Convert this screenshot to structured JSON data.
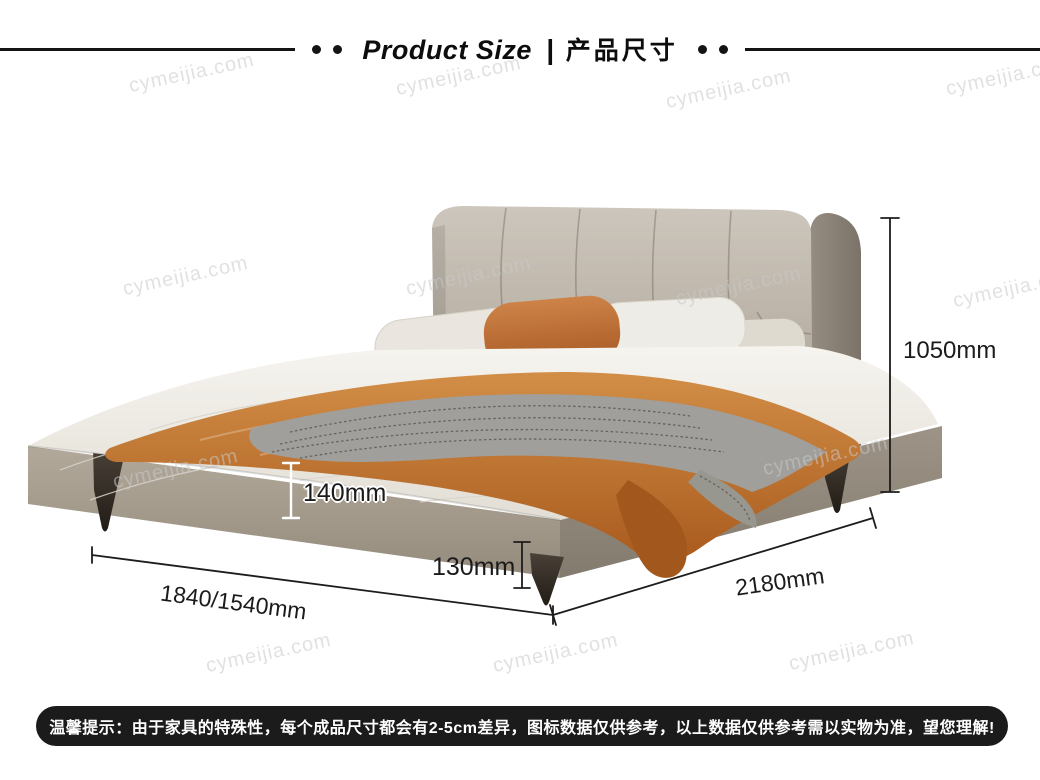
{
  "header": {
    "title_en": "Product Size",
    "separator": "|",
    "title_cn": "产品尺寸"
  },
  "watermark": {
    "text": "cymeijia.com"
  },
  "dimensions": {
    "height": "1050mm",
    "frame_height": "140mm",
    "leg_height": "130mm",
    "width": "1840/1540mm",
    "depth": "2180mm"
  },
  "notice": {
    "text": "温馨提示：由于家具的特殊性，每个成品尺寸都会有2-5cm差异，图标数据仅供参考，以上数据仅供参考需以实物为准，望您理解!"
  },
  "colors": {
    "line": "#1c1c1c",
    "notice_bg": "#1b1b1b",
    "notice_text": "#ffffff",
    "headboard": "#b7afa3",
    "headboard_wing": "#8d8478",
    "frame": "#a49b8d",
    "mattress": "#f0eee8",
    "blanket_orange": "#c27a33",
    "blanket_gray": "#a09f9b",
    "pillow_orange": "#b96a2e",
    "legs": "#35302a",
    "watermark": "#c9c9c9"
  }
}
